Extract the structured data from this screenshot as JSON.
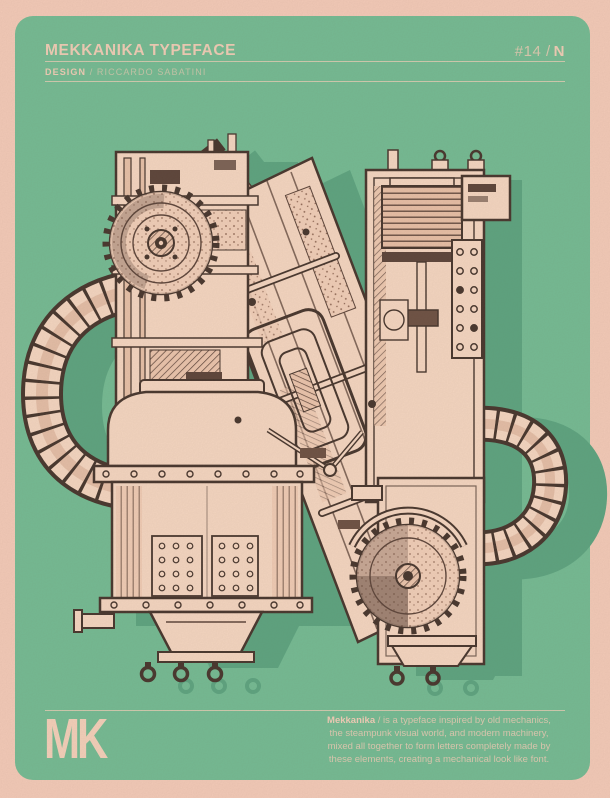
{
  "poster": {
    "title": "MEKKANIKA TYPEFACE",
    "issue": {
      "prefix": "#14 /",
      "letter": "N"
    },
    "credit": {
      "label": "DESIGN",
      "value": "/ RICCARDO SABATINI"
    },
    "letter": "N",
    "logo_text": "MK",
    "blurb": {
      "lead_bold": "Mekkanika",
      "line1_rest": " / is a typeface inspired by old mechanics,",
      "line2": "the steampunk visual world, and modern machinery,",
      "line3": "mixed all together to form letters completely made by",
      "line4": "these elements, creating a mechanical look like font."
    },
    "colors": {
      "frame_pink": "#f6ccba",
      "panel_green": "#72bc94",
      "shadow_green": "#5aa480",
      "machine_cream": "#f7d8c3",
      "machine_line_dark": "#44332b",
      "text_cream": "#f2cfb8"
    }
  }
}
